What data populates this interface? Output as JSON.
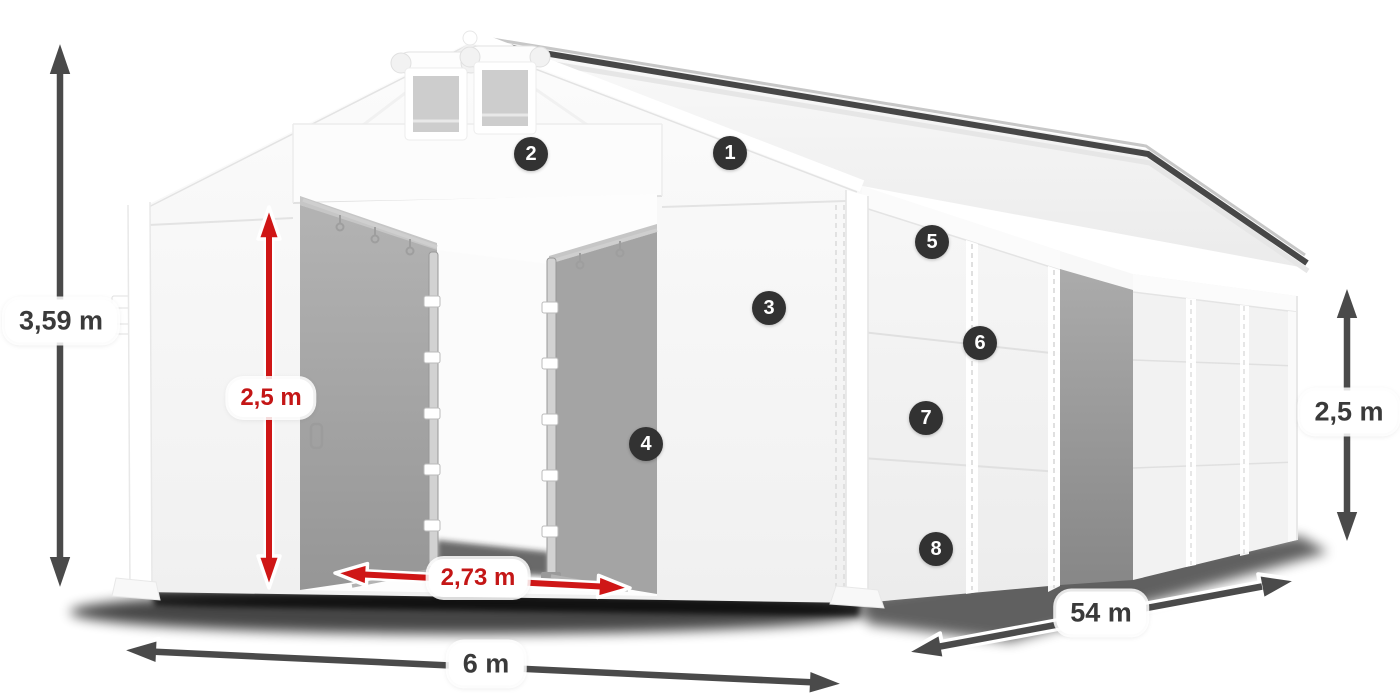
{
  "diagram": {
    "measurements": {
      "total_height": {
        "value": "3,59 m"
      },
      "entrance_height": {
        "value": "2,5 m"
      },
      "entrance_width": {
        "value": "2,73 m"
      },
      "width": {
        "value": "6 m"
      },
      "length": {
        "value": "54 m"
      },
      "side_height": {
        "value": "2,5 m"
      }
    },
    "callouts": [
      "1",
      "2",
      "3",
      "4",
      "5",
      "6",
      "7",
      "8"
    ],
    "colors": {
      "dimension_arrow": "#4a4a4a",
      "highlight_arrow": "#cf1616",
      "highlight_text": "#c41616",
      "badge_background": "#323232",
      "badge_number": "#ffffff",
      "label_background": "#ffffff",
      "label_text": "#3a3a3a"
    }
  }
}
